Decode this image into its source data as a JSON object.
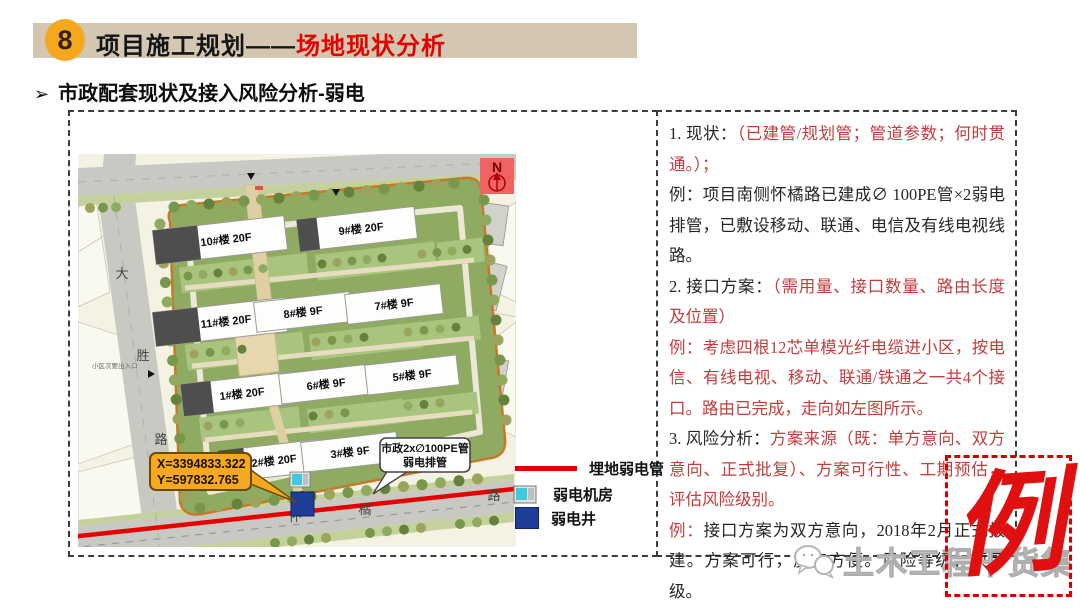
{
  "header": {
    "number": "8",
    "title": "项目施工规划——",
    "title_highlight": "场地现状分析"
  },
  "subtitle": {
    "bullet": "➢",
    "text": "市政配套现状及接入风险分析-弱电"
  },
  "map": {
    "north": "N",
    "road_left": [
      "大",
      "胜",
      "路"
    ],
    "road_bottom": [
      "怀",
      "橘",
      "路"
    ],
    "side_gate": "小区次要出入口",
    "buildings": [
      {
        "label": "10#楼 20F"
      },
      {
        "label": "9#楼 20F"
      },
      {
        "label": "11#楼 20F"
      },
      {
        "label": "8#楼 9F"
      },
      {
        "label": "7#楼 9F"
      },
      {
        "label": "1#楼 20F"
      },
      {
        "label": "6#楼 9F"
      },
      {
        "label": "5#楼 9F"
      },
      {
        "label": "2#楼 20F"
      },
      {
        "label": "3#楼 9F"
      }
    ],
    "coord_callout": {
      "x": "X=3394833.322",
      "y": "Y=597832.765"
    },
    "pipe_callout": {
      "line1": "市政2x∅100PE管",
      "line2": "弱电排管"
    }
  },
  "legend": {
    "items": [
      {
        "label": "埋地弱电管"
      },
      {
        "label": "弱电机房"
      },
      {
        "label": "弱电井"
      }
    ]
  },
  "analysis": {
    "paragraphs": [
      {
        "head": "1. 现状：",
        "body": "（已建管/规划管；管道参数；何时贯通。）；"
      },
      {
        "head": "例：",
        "body": "项目南侧怀橘路已建成∅ 100PE管×2弱电排管，已敷设移动、联通、电信及有线电视线路。"
      },
      {
        "head": "2. 接口方案：",
        "body": "（需用量、接口数量、路由长度及位置）"
      },
      {
        "head": "例：",
        "body": "考虑四根12芯单模光纤电缆进小区，按电信、有线电视、移动、联通/铁通之一共4个接口。路由已完成，走向如左图所示。"
      },
      {
        "head": "3. 风险分析：",
        "body": "方案来源（既：单方意向、双方意向、正式批复）、方案可行性、工期预估，评估风险级别。"
      },
      {
        "head": "例：",
        "body": "接口方案为双方意向，2018年2月正式报建。方案可行，施工方便。风险等级：项目级。"
      }
    ]
  },
  "stamp": "例",
  "watermark": "土木工程干货集",
  "colors": {
    "header_bar": "#D3C7B1",
    "badge_orange": "#F5A81E",
    "accent_red": "#E60000",
    "text_red": "#C43C3C",
    "pipe_red": "#E60000",
    "well_blue": "#1E3D96",
    "room_cyan": "#3FC9DE",
    "callout_yellow": "#F6A820",
    "stamp_red": "#E01010"
  }
}
